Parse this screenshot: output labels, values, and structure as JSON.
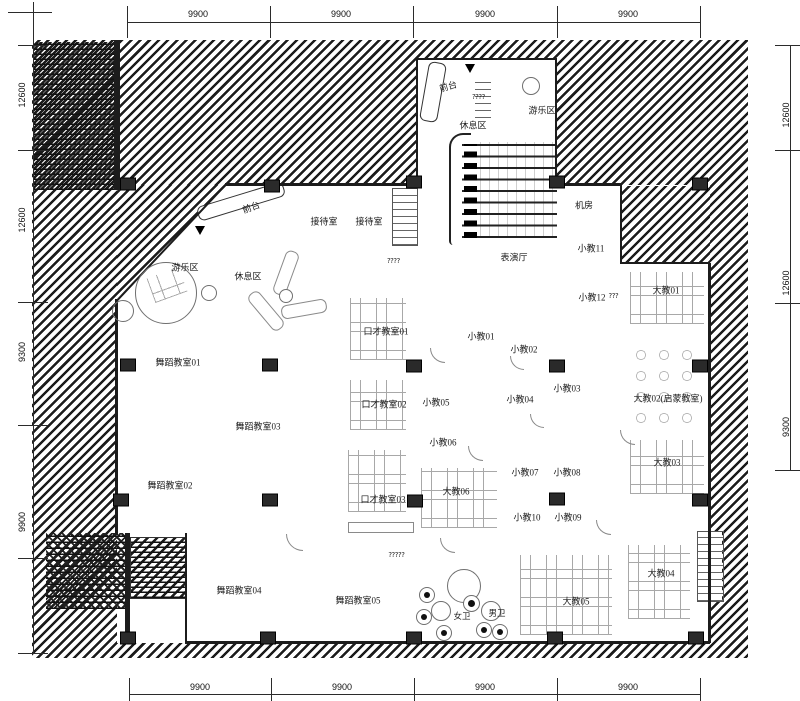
{
  "dims": {
    "top": [
      "9900",
      "9900",
      "9900",
      "9900"
    ],
    "bottom": [
      "9900",
      "9900",
      "9900",
      "9900"
    ],
    "left": [
      "12600",
      "12600",
      "9300",
      "9900"
    ],
    "right": [
      "12600",
      "12600",
      "9300"
    ]
  },
  "zones": {
    "front_desk_top": "前台",
    "play_top": "游乐区",
    "rest_top": "休息区",
    "front_desk": "前台",
    "play": "游乐区",
    "rest": "休息区",
    "hall": "表演厅",
    "wc_f": "女卫",
    "wc_m": "男卫"
  },
  "rooms": [
    {
      "label": "接待室"
    },
    {
      "label": "接待室"
    },
    {
      "label": "机房"
    },
    {
      "label": "小教11"
    },
    {
      "label": "小教12"
    },
    {
      "label": "大教01"
    },
    {
      "label": "大教02(启蒙教室)"
    },
    {
      "label": "大教03"
    },
    {
      "label": "大教04"
    },
    {
      "label": "大教05"
    },
    {
      "label": "大教06"
    },
    {
      "label": "小教01"
    },
    {
      "label": "小教02"
    },
    {
      "label": "小教03"
    },
    {
      "label": "小教04"
    },
    {
      "label": "小教05"
    },
    {
      "label": "小教06"
    },
    {
      "label": "小教07"
    },
    {
      "label": "小教08"
    },
    {
      "label": "小教09"
    },
    {
      "label": "小教10"
    },
    {
      "label": "口才教室01"
    },
    {
      "label": "口才教室02"
    },
    {
      "label": "口才教室03"
    },
    {
      "label": "舞蹈教室01"
    },
    {
      "label": "舞蹈教室02"
    },
    {
      "label": "舞蹈教室03"
    },
    {
      "label": "舞蹈教室04"
    },
    {
      "label": "舞蹈教室05"
    }
  ],
  "artifacts": [
    "????",
    "?????",
    "????",
    "???"
  ]
}
